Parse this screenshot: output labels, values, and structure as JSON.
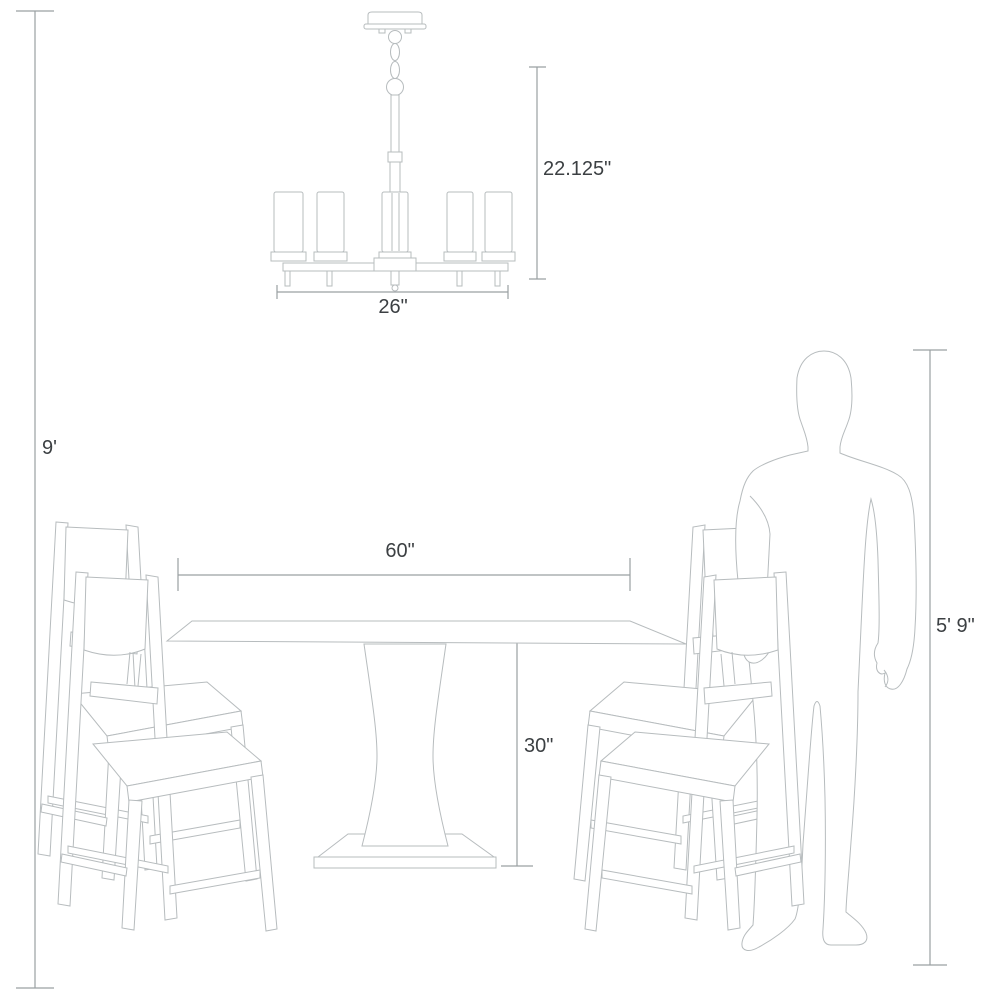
{
  "diagram": {
    "type": "furniture-dimension-diagram",
    "scene": [
      "chandelier",
      "dining-table",
      "four-dining-chairs",
      "standing-person"
    ],
    "colors": {
      "background": "#ffffff",
      "drawing_line": "#b7bcbe",
      "dimension_line": "#9aa0a2",
      "label_text": "#3c4043"
    }
  },
  "labels": {
    "ceiling_height": "9'",
    "chandelier_height": "22.125\"",
    "chandelier_width": "26\"",
    "table_width": "60\"",
    "table_height": "30\"",
    "person_height": "5' 9\""
  }
}
